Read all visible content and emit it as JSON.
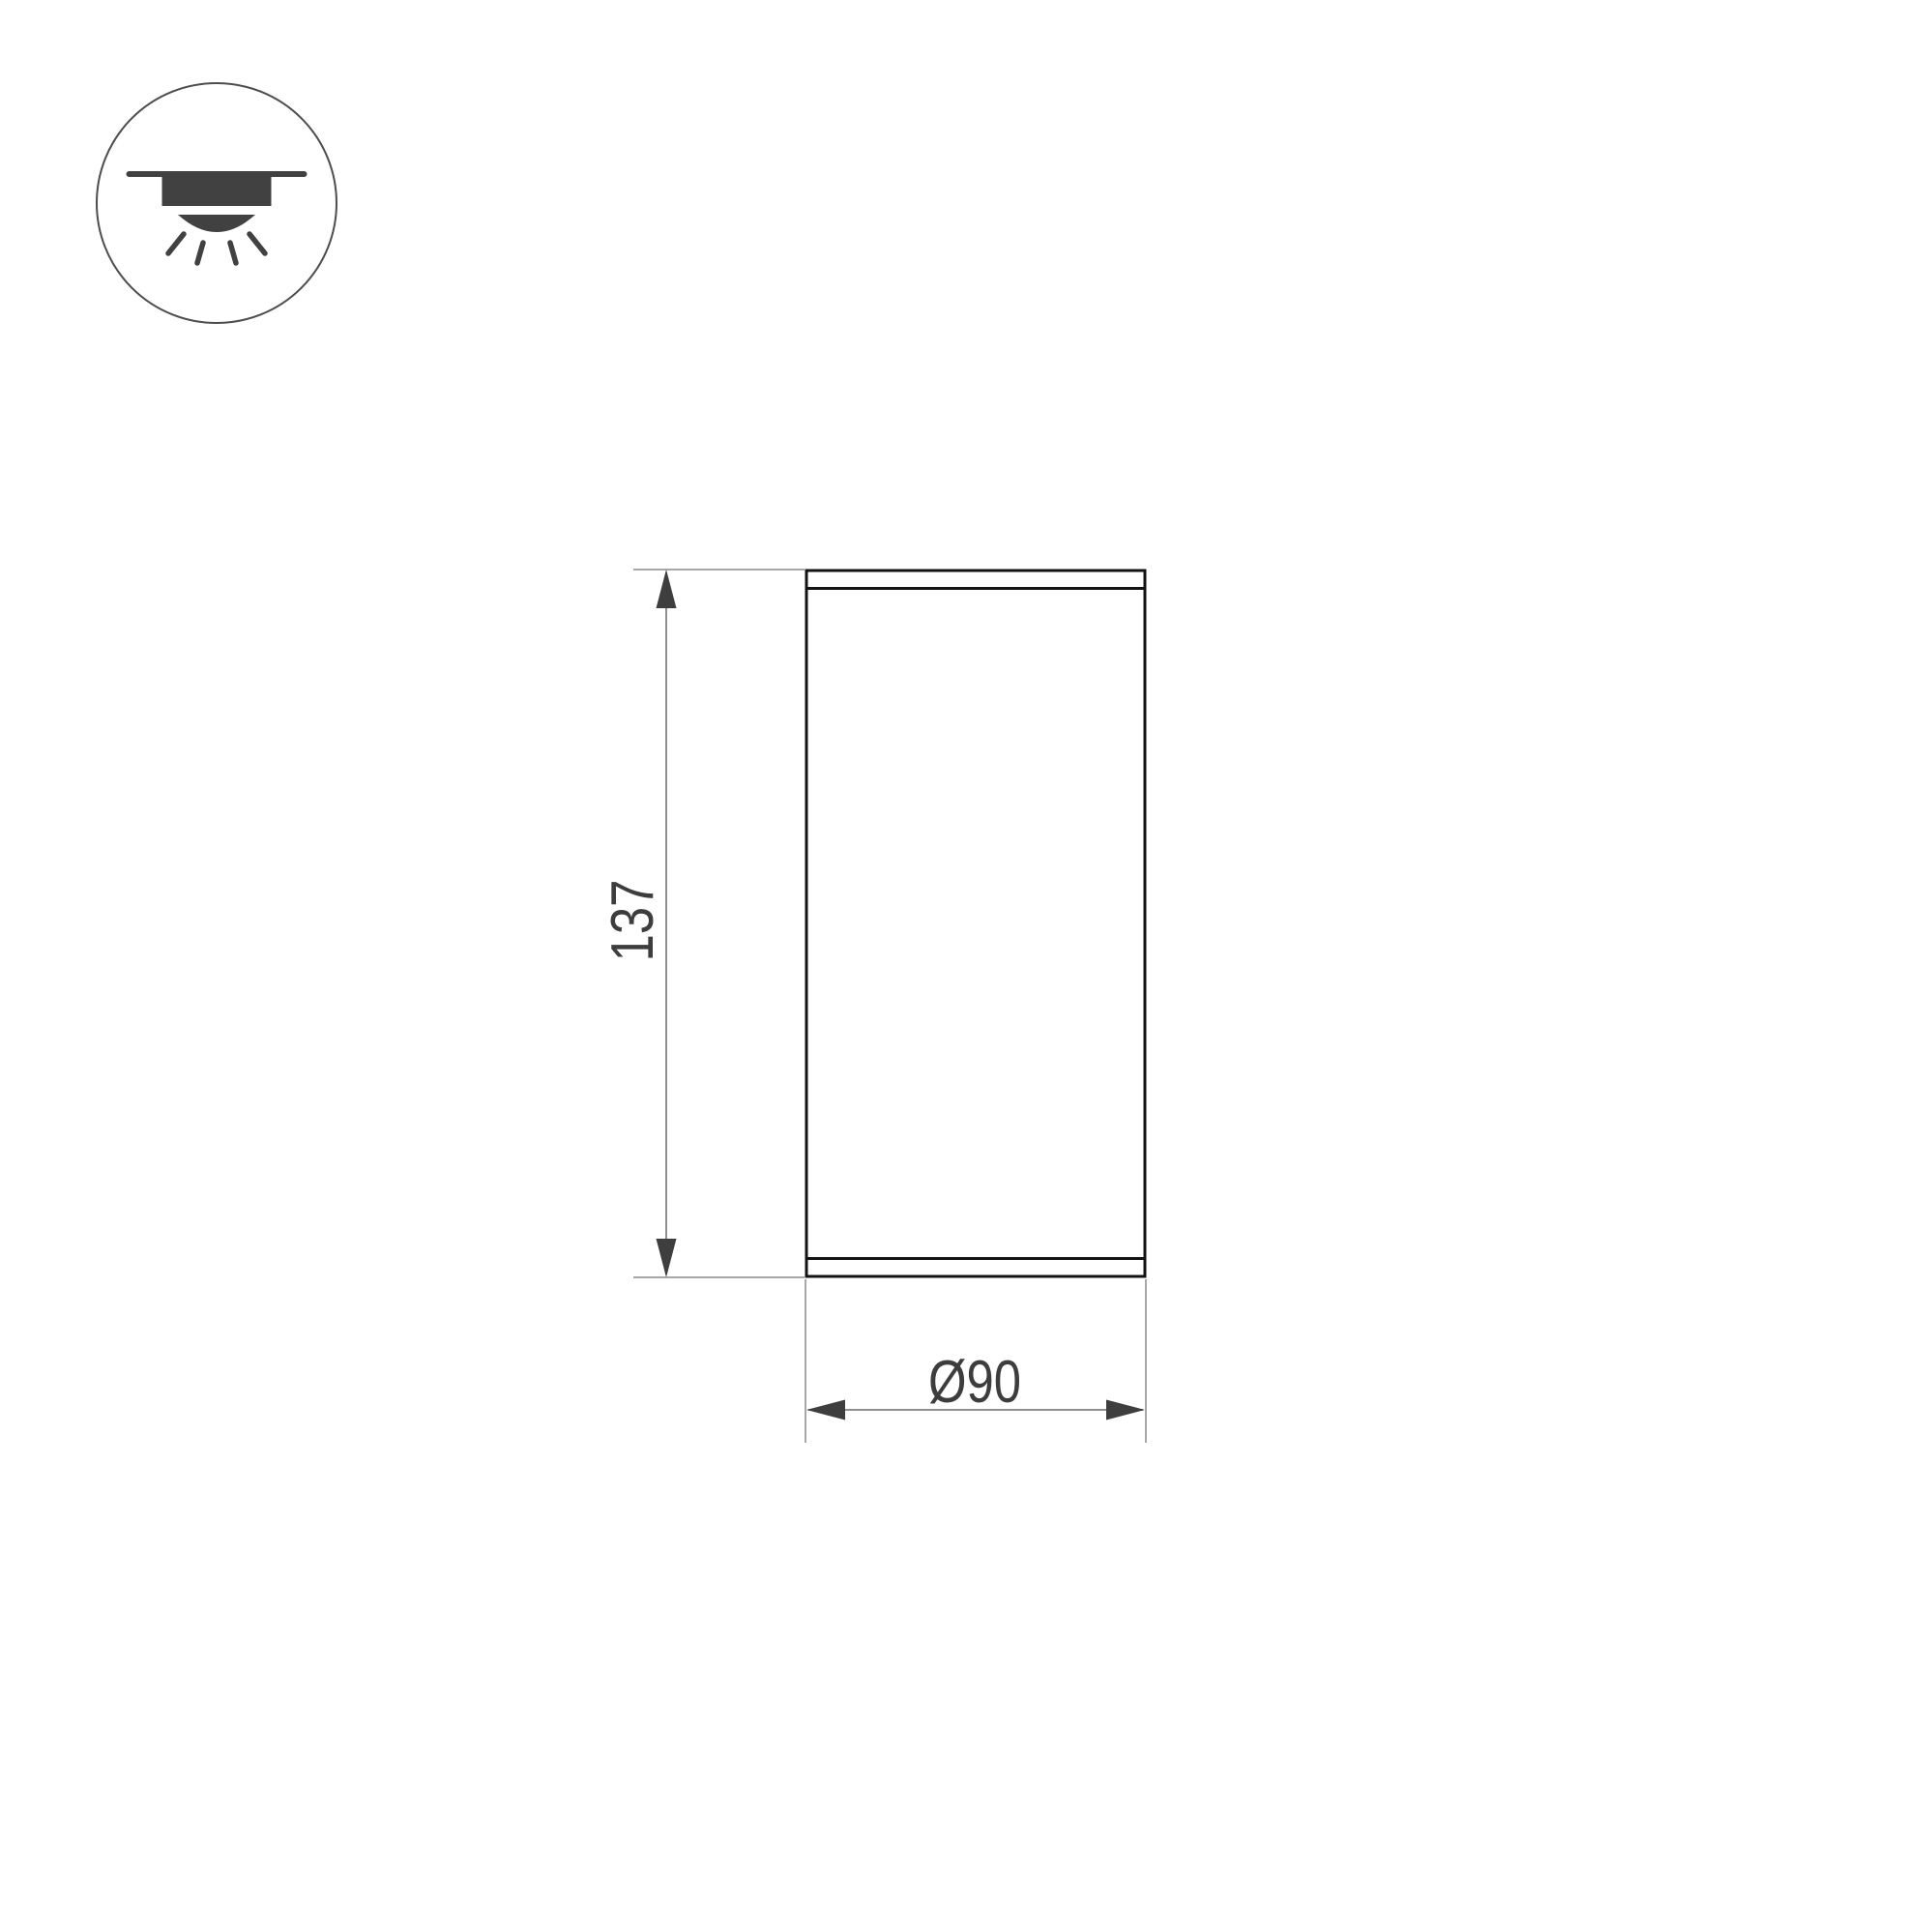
{
  "drawing": {
    "kind": "technical-dimension-drawing",
    "icon": "surface-mounted-downlight-icon",
    "dimensions": {
      "height": {
        "value": "137"
      },
      "diameter": {
        "value": "Ø90"
      }
    },
    "colors": {
      "outline_dark": "#131313",
      "dimension_line_gray": "#8f8f8f",
      "extension_line_gray": "#a8a8a8",
      "arrow_dark": "#3e3e3e",
      "icon_dark": "#414141",
      "text_gray": "#3d3d3d",
      "background": "#ffffff"
    }
  }
}
